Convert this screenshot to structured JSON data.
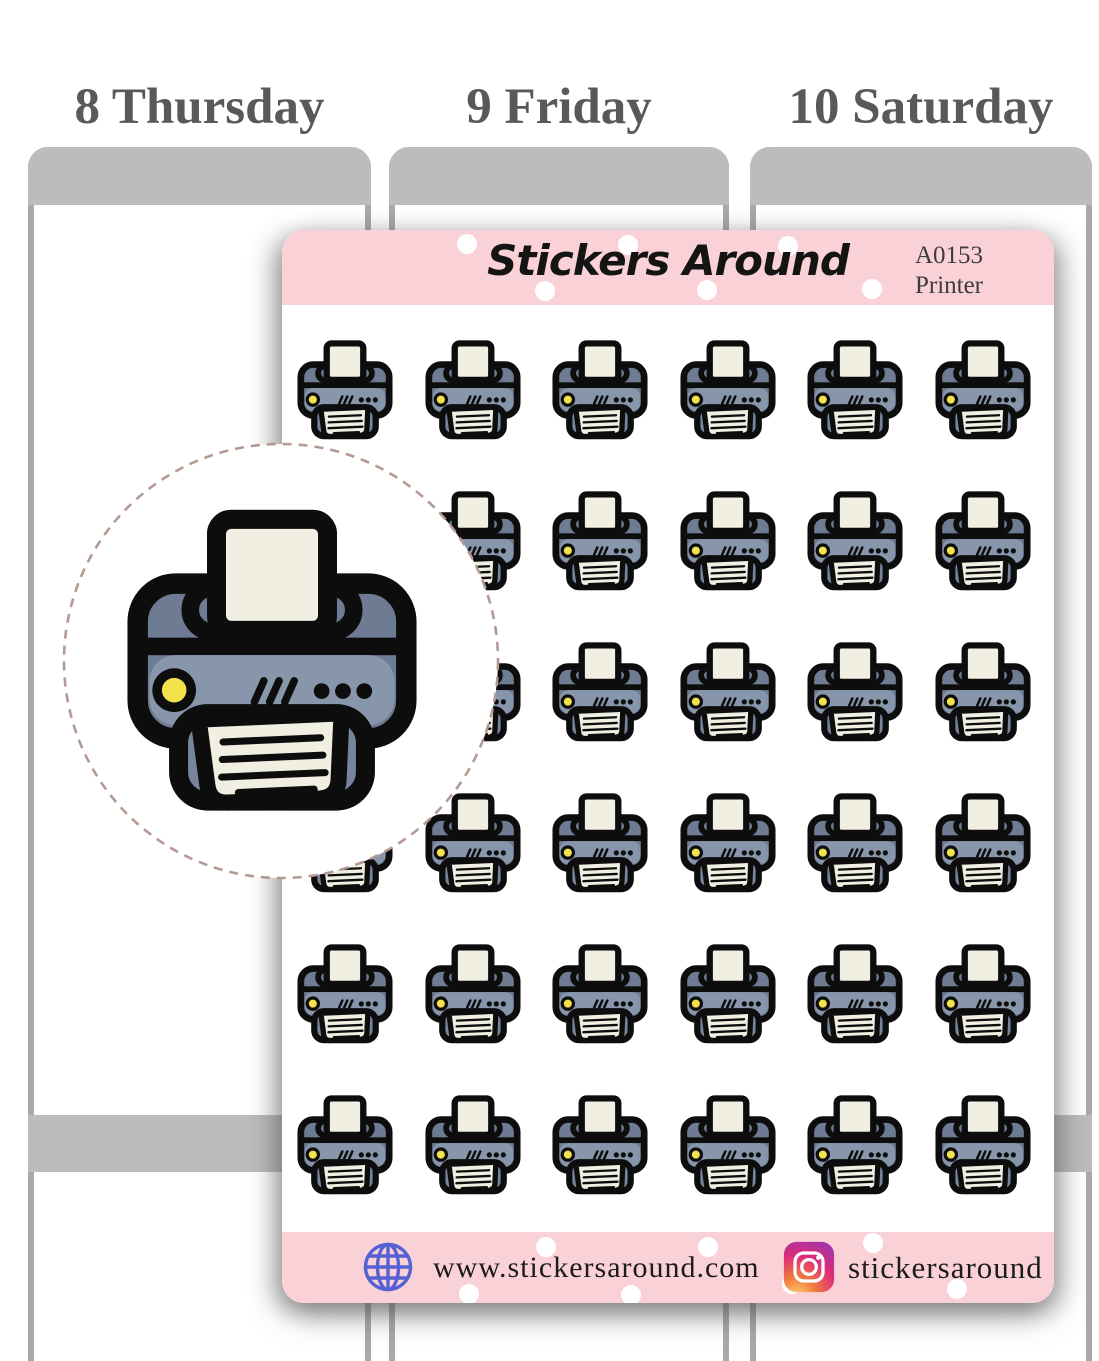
{
  "planner": {
    "days": [
      {
        "label": "8 Thursday"
      },
      {
        "label": "9 Friday"
      },
      {
        "label": "10 Saturday"
      }
    ]
  },
  "sheet": {
    "brand": "Stickers Around",
    "sku": "A0153",
    "product_name": "Printer",
    "grid": {
      "rows": 6,
      "cols": 6,
      "icon": "printer-icon",
      "sticker_count": 36
    },
    "footer": {
      "website": "www.stickersaround.com",
      "instagram_handle": "stickersaround"
    }
  },
  "icons": {
    "sticker": "printer-icon",
    "website": "globe-icon",
    "social": "instagram-icon",
    "detail": "zoom-detail-circle"
  },
  "colors": {
    "band_pink": "#f9d1d6",
    "outline_ink": "#0d0d0d",
    "paper_cream": "#f0efe2",
    "slate_dark": "#6d7c92",
    "slate_mid": "#76859c",
    "slate_light": "#8796ab",
    "led_yellow": "#f4e24d",
    "circle_dash": "#b49a92",
    "planner_gray": "#bcbcbc",
    "planner_border": "#a9a9a9",
    "day_text": "#595959",
    "brand_text": "#141414",
    "sku_text": "#3c3c3c",
    "footer_text": "#1c1c1c",
    "globe_blue": "#5561d2",
    "ig_yellow": "#fdd476",
    "ig_orange": "#f0793e",
    "ig_pink": "#dd2a7b",
    "ig_purple": "#8a3ab9"
  }
}
